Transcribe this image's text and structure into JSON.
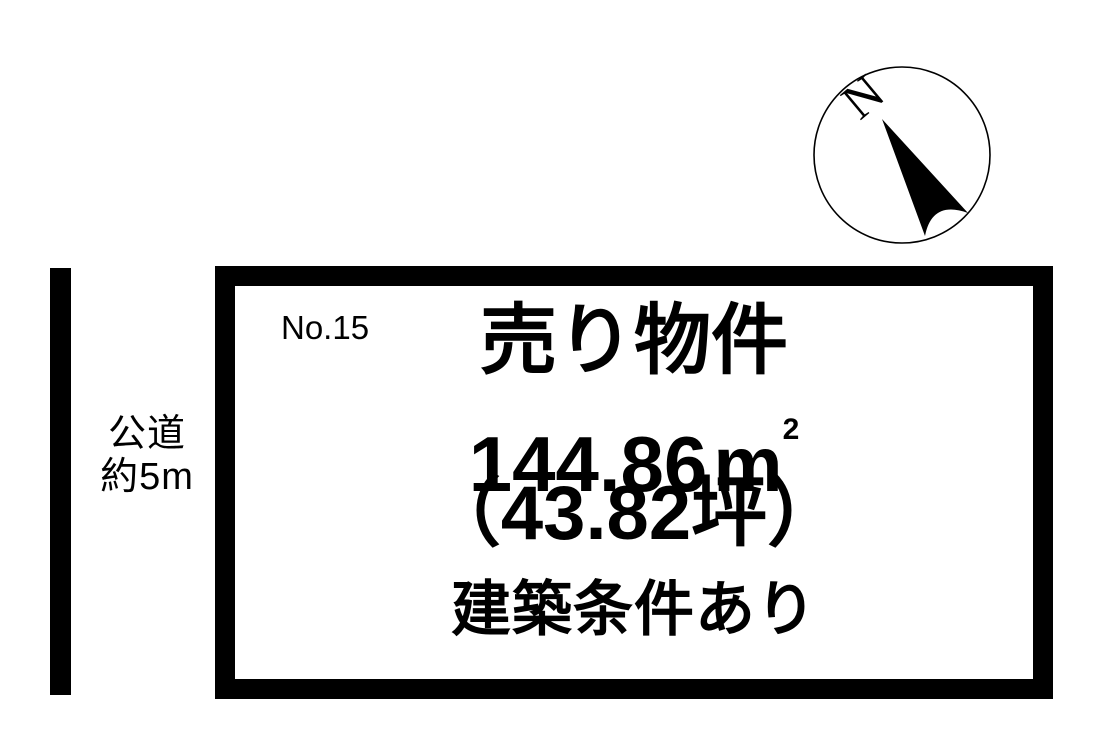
{
  "diagram": {
    "compass": {
      "north_label": "N"
    },
    "road": {
      "line1": "公道",
      "line2": "約5m"
    },
    "plot": {
      "number": "No.15",
      "title": "売り物件",
      "area_value": "144.86",
      "area_unit": "m",
      "area_sup": "2",
      "tsubo": "（43.82坪）",
      "note": "建築条件あり"
    },
    "colors": {
      "ink": "#000000",
      "background": "#ffffff"
    }
  }
}
